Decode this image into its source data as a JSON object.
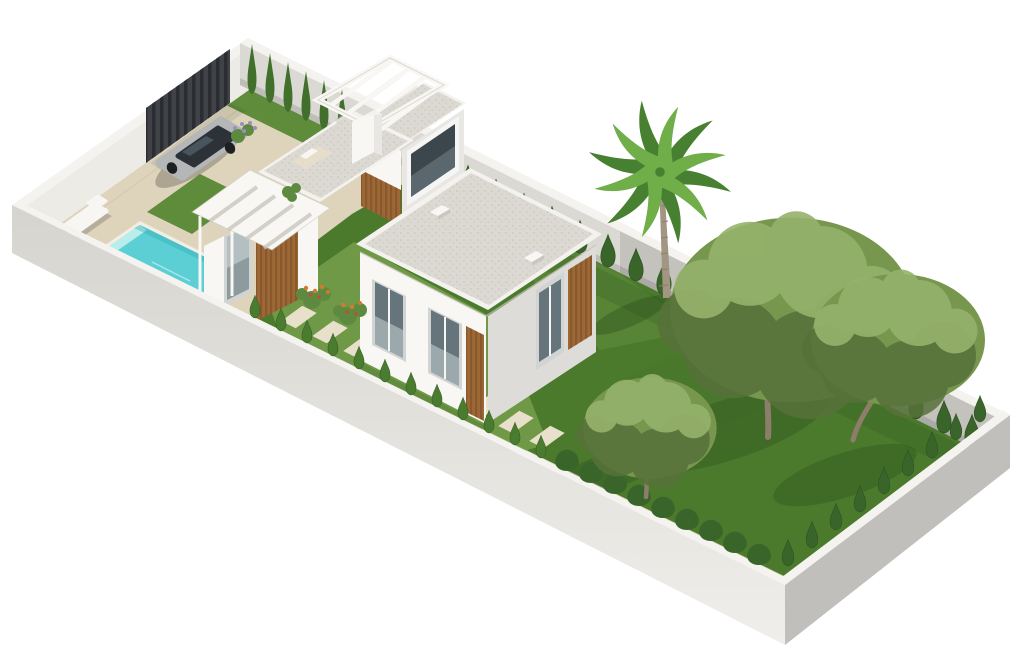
{
  "scene": {
    "type": "3d-architectural-render",
    "description": "Isometric aerial 3D rendering of a walled villa plot: modern white house with wood-slat accents and gravel flat roofs, rooftop pergola terrace, turquoise swimming pool with sun lounger, beige paved driveway with parked silver car, dark slatted entrance gate, stepping-stone path, lawns, hedge rows, one fan palm and three mature olive trees.",
    "view": "isometric aerial from south-east",
    "background": "#ffffff"
  },
  "objects": {
    "perimeter_wall": "white perimeter wall",
    "entrance_gate": "dark slatted entrance gate",
    "driveway": "beige paved driveway and pool terrace",
    "car": "silver car parked on driveway",
    "pool": "rectangular turquoise swimming pool",
    "sun_lounger": "white sun lounger beside pool",
    "house": "modern white villa with wood slat cladding",
    "tower": "two-storey volume with large dark corner window",
    "roof_terrace": "gravel roof terrace with white pergola and chimney",
    "entry_porch": "entry porch with slatted canopy, glass door and wood feature wall",
    "stepping_stones": "diagonal stepping-stone path across front lawn",
    "front_hedge_row": "row of small conical hedges along front wall",
    "rear_hedge_row": "row of conical hedges along rear wall",
    "side_hedge_row": "row of conical hedges along right wall",
    "cypress_screen": "tall cypress screen beside gate",
    "palm_tree": "fan palm tree by rear wall",
    "olive_trees": "three mature olive trees on rear lawn",
    "planting": "flowering shrubs, lavender and ornamental grasses"
  },
  "counts": {
    "stepping_stones": 10,
    "front_cone_hedges": 12,
    "front_bush_hedges": 9,
    "side_cone_hedges": 9,
    "rear_cone_hedges": 20,
    "cypresses": 6,
    "large_trees": 3,
    "palm_trees": 1,
    "skylights": 2,
    "cars": 1
  },
  "colors": {
    "background": "#ffffff",
    "paving": "#ded4bc",
    "pavingJoint": "#c8bc9f",
    "stone": "#e8e0ca",
    "grassLight": "#7ba450",
    "grassMid": "#5f8c3b",
    "grassDark": "#4b7a2c",
    "grassShadow": "#2e5420",
    "hedgeMid": "#4a7c30",
    "hedgeDark": "#3a652a",
    "hedgeEdge": "#2d5020",
    "cypress": "#40702b",
    "treeLight": "#96b26c",
    "treeMid": "#77964e",
    "treeDark": "#57713a",
    "trunkBrown": "#8d7e6b",
    "palmLight": "#6fae49",
    "palmDark": "#478030",
    "palmTrunk": "#a29682",
    "palmRing": "#8b7f6c",
    "wallWhite": "#f4f3ef",
    "wallInnerLight": "#edebe6",
    "wallInnerShade": "#dbd9d3",
    "wallOuterLight": "#d6d4cf",
    "wallOuterFade": "#efeeea",
    "wallOuterDark": "#c0bfbc",
    "gateDark": "#3f4347",
    "gateSlat": "#25282b",
    "houseWhite": "#f8f7f3",
    "houseShade": "#e8e7e3",
    "houseShadeDark": "#dddcd8",
    "woodLight": "#9e6836",
    "woodDark": "#774c26",
    "roofGravel": "#dcd9d3",
    "roofSpeck": "#c6c2b9",
    "parapet": "#f3f2ee",
    "edgeShade": "#c9c6bf",
    "glassDark": "#3c474d",
    "glassMid": "#66757c",
    "glassLight": "#b4bfc1",
    "frameGray": "#d2d4d3",
    "mullion": "#f5f5f3",
    "poolRim": "#f1eee6",
    "poolWater": "#5bcfd4",
    "poolDeep": "#2da4b0",
    "poolStep": "#b7edea",
    "ripple": "#d8f6f3",
    "carBody": "#b4b6b8",
    "carDark": "#2c3237",
    "carGlassHi": "#5d6d77",
    "wheel": "#1d1f21",
    "loungerWhite": "#f7f6f3",
    "flowerGreen": "#5d8a40",
    "flowerOrange": "#d8782f",
    "flowerRed": "#c14f2c",
    "lavender": "#9a8ec6",
    "skylightSide": "#c9c6c0",
    "shadowInk": "#000000",
    "terraceMat": "#e9dfc8"
  }
}
